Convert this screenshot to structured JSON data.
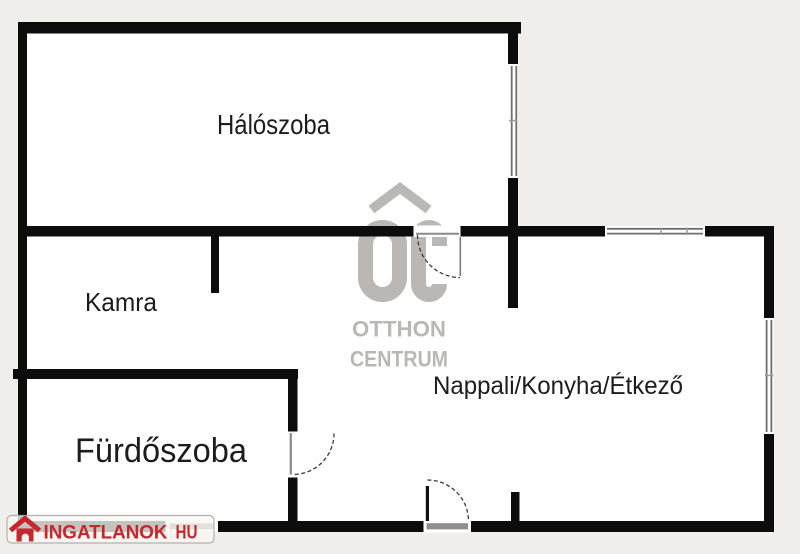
{
  "rooms": {
    "bedroom": {
      "label": "Hálószoba"
    },
    "pantry": {
      "label": "Kamra"
    },
    "bathroom": {
      "label": "Fürdőszoba"
    },
    "living": {
      "label": "Nappali/Konyha/Étkező"
    }
  },
  "watermark": {
    "logo_letters": "OC",
    "logo_icon": "house-roof-chevron",
    "line1": "OTTHON",
    "line2": "CENTRUM",
    "color": "#b9b8b5"
  },
  "logo_badge": {
    "icon": "red-house-icon",
    "text": "INGATLANOK",
    "separator": ":",
    "tld": "HU",
    "color": "#c4272e"
  },
  "colors": {
    "background": "#f0eeea",
    "wall": "#0c0c0c",
    "room_fill": "#ffffff",
    "label": "#1c1c1c",
    "window_line": "#6f6f6f",
    "door_arc": "#3c3c3c"
  }
}
